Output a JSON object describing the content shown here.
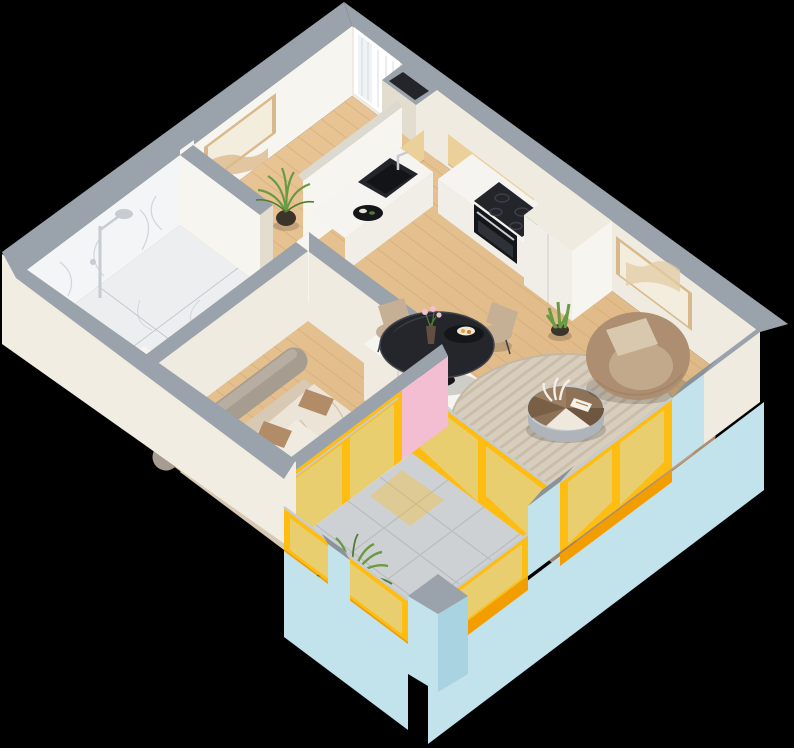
{
  "scene": {
    "title": "Isometric 3D floor plan — one-bedroom apartment",
    "description": "Cutaway isometric 3D render of a one-bedroom apartment on a black background: marble bathroom with rain shower, bedroom with double bed and rounded headboard bench, L-shaped kitchen with black cooktop, oven and sink, living-dining area with round glass dining table, striped round rug, round coffee table, armchair and sofa, and a wrap-around balcony with yellow window frames, pale-blue exterior walls and a fern planter.",
    "rooms": [
      {
        "name": "Bathroom",
        "position": "west corner",
        "features": [
          "marble tiled walls",
          "marble floor",
          "chrome rain shower",
          "white vanity with sink"
        ]
      },
      {
        "name": "Bedroom",
        "position": "south-west",
        "features": [
          "double bed with beige bedding",
          "two tan pillows",
          "rounded fabric headboard bench",
          "pink accent wall",
          "sliding balcony door with yellow frame",
          "pink flowers"
        ]
      },
      {
        "name": "Kitchen",
        "position": "north corner",
        "features": [
          "L-shaped white counter",
          "black induction cooktop",
          "built-in black oven",
          "black sink",
          "oak upper cabinets",
          "tall pantry cabinet",
          "corner window with curtain",
          "service shaft"
        ]
      },
      {
        "name": "Living-Dining",
        "position": "center and east",
        "features": [
          "round black glass dining table",
          "three taupe dining chairs",
          "pink flower vase and serving plate",
          "striped round rug",
          "round segmented coffee table with decor book and plumes",
          "brown lounge armchair with cushion",
          "curved brown sofa",
          "beige pouf",
          "white wardrobe",
          "two framed wall artworks",
          "kentia palm plant",
          "snake plant"
        ]
      },
      {
        "name": "Balcony",
        "position": "south corner and south-east edge",
        "features": [
          "stone tile floor",
          "glass balustrades with yellow frames",
          "pale blue pillars with gray caps",
          "floor-to-ceiling windows",
          "fern planter",
          "yellow sun glow on floor"
        ]
      }
    ],
    "palette": {
      "bg": "#000000",
      "cap": "#9aa2ab",
      "capDark": "#8a929b",
      "cream": "#efebe1",
      "creamDark": "#e3ddd0",
      "white": "#f7f5ef",
      "cabinet": "#f1eee7",
      "counter": "#f6f4f0",
      "extWhite": "#f1ede3",
      "blue": "#c2e2ec",
      "blueDark": "#a9d3e0",
      "yellow": "#ffbc11",
      "yellowDeep": "#f29d00",
      "glass": "rgba(200,230,240,0.42)",
      "wood": "#e5c191",
      "woodDark": "#d9b27e",
      "plank": "#c99f69",
      "oak": "#ecd09a",
      "oakDark": "#e0c084",
      "black1": "#15161a",
      "black2": "#23252b",
      "taupe": "#ad8e70",
      "taupeDark": "#9c7f64",
      "taupeLight": "#c5b096",
      "bedBase": "#d8c9b4",
      "duvet": "#ece4d6",
      "pillowTan": "#b18c67",
      "headboard": "#a69d90",
      "rugA": "#d8cebd",
      "rugB": "#cabdaa",
      "tile": "#ced1d3",
      "grout": "#b6babd",
      "pink": "#f4bed2",
      "green": "#6a9a43",
      "greenDark": "#4f7c31",
      "chrome": "#c6ccd2",
      "pot": "#3c332a",
      "marbleWall": "#f3f5f7",
      "marbleFloor": "#eceef0",
      "marbleVein": "#c3c9d2",
      "frameWood": "#d9b98c",
      "canvasTint": "#f3eddd"
    }
  }
}
